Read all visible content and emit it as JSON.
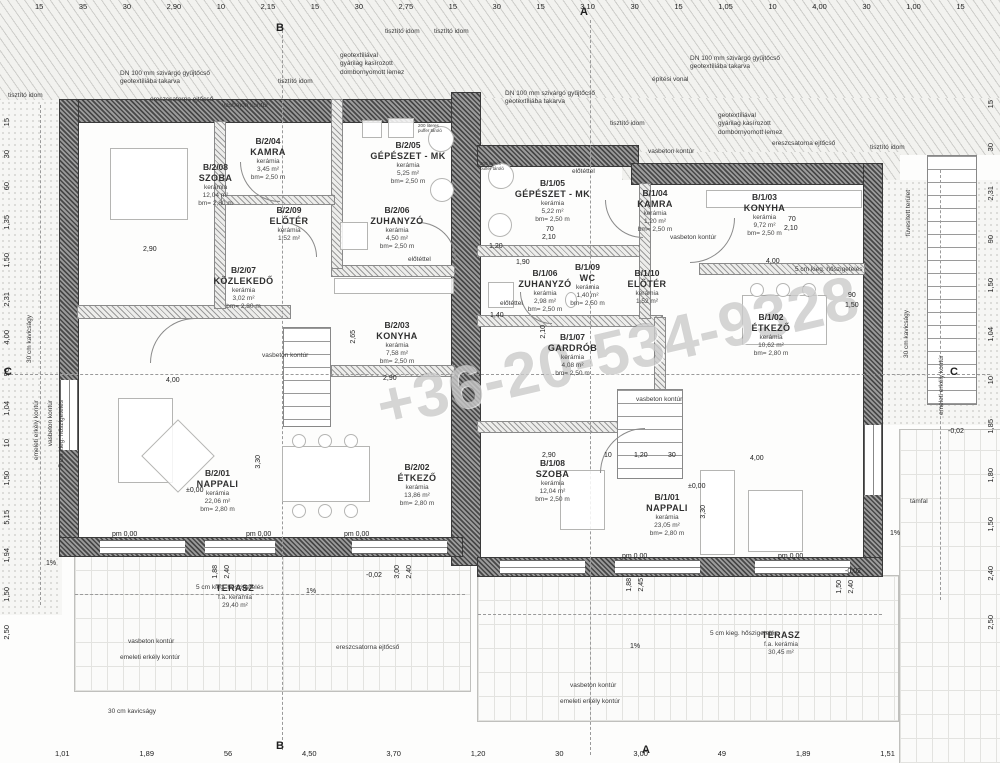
{
  "watermark": {
    "text": "+36-20-534-9328"
  },
  "colors": {
    "paper": "#fdfdfc",
    "wall_dark": "#474747",
    "hatch_line": "#cdcdca",
    "text": "#2f2f2f",
    "watermark": "rgba(115,115,115,0.30)"
  },
  "rooms": [
    {
      "id": "B/2/08",
      "name": "SZOBA",
      "mat": "kerámia",
      "area": "12,04 m²",
      "hgt": "bm= 2,80 m",
      "x": 168,
      "y": 162,
      "w": 95
    },
    {
      "id": "B/2/04",
      "name": "KAMRA",
      "mat": "kerámia",
      "area": "3,45 m²",
      "hgt": "bm= 2,50 m",
      "x": 228,
      "y": 136,
      "w": 80
    },
    {
      "id": "B/2/05",
      "name": "GÉPÉSZET - MK",
      "mat": "kerámia",
      "area": "5,25 m²",
      "hgt": "bm= 2,50 m",
      "x": 358,
      "y": 140,
      "w": 100
    },
    {
      "id": "B/2/09",
      "name": "ELŐTÉR",
      "mat": "kerámia",
      "area": "1,52 m²",
      "hgt": "",
      "x": 250,
      "y": 205,
      "w": 78
    },
    {
      "id": "B/2/06",
      "name": "ZUHANYZÓ",
      "mat": "kerámia",
      "area": "4,50 m²",
      "hgt": "bm= 2,50 m",
      "x": 352,
      "y": 205,
      "w": 90
    },
    {
      "id": "B/2/07",
      "name": "KÖZLEKEDŐ",
      "mat": "kerámia",
      "area": "3,02 m²",
      "hgt": "bm= 2,80 m",
      "x": 196,
      "y": 265,
      "w": 95
    },
    {
      "id": "B/2/03",
      "name": "KONYHA",
      "mat": "kerámia",
      "area": "7,58 m²",
      "hgt": "bm= 2,50 m",
      "x": 352,
      "y": 320,
      "w": 90
    },
    {
      "id": "B/2/01",
      "name": "NAPPALI",
      "mat": "kerámia",
      "area": "22,06 m²",
      "hgt": "bm= 2,80 m",
      "x": 170,
      "y": 468,
      "w": 95
    },
    {
      "id": "B/2/02",
      "name": "ÉTKEZŐ",
      "mat": "kerámia",
      "area": "13,86 m²",
      "hgt": "bm= 2,80 m",
      "x": 372,
      "y": 462,
      "w": 90
    },
    {
      "id": "",
      "name": "TERASZ",
      "mat": "f.a. kerámia",
      "area": "29,40 m²",
      "hgt": "",
      "x": 190,
      "y": 583,
      "w": 90
    },
    {
      "id": "B/1/05",
      "name": "GÉPÉSZET - MK",
      "mat": "kerámia",
      "area": "5,22 m²",
      "hgt": "bm= 2,50 m",
      "x": 500,
      "y": 178,
      "w": 105
    },
    {
      "id": "B/1/04",
      "name": "KAMRA",
      "mat": "kerámia",
      "area": "1,20 m²",
      "hgt": "bm= 2,50 m",
      "x": 615,
      "y": 188,
      "w": 80
    },
    {
      "id": "B/1/03",
      "name": "KONYHA",
      "mat": "kerámia",
      "area": "9,72 m²",
      "hgt": "bm= 2,50 m",
      "x": 722,
      "y": 192,
      "w": 85
    },
    {
      "id": "B/1/06",
      "name": "ZUHANYZÓ",
      "mat": "kerámia",
      "area": "2,98 m²",
      "hgt": "bm= 2,50 m",
      "x": 500,
      "y": 268,
      "w": 90
    },
    {
      "id": "B/1/09",
      "name": "WC",
      "mat": "kerámia",
      "area": "1,40 m²",
      "hgt": "bm= 2,50 m",
      "x": 560,
      "y": 262,
      "w": 55
    },
    {
      "id": "B/1/10",
      "name": "ELŐTÉR",
      "mat": "kerámia",
      "area": "1,52 m²",
      "hgt": "",
      "x": 612,
      "y": 268,
      "w": 70
    },
    {
      "id": "B/1/07",
      "name": "GARDRÓB",
      "mat": "kerámia",
      "area": "4,08 m²",
      "hgt": "bm= 2,50 m",
      "x": 530,
      "y": 332,
      "w": 85
    },
    {
      "id": "B/1/02",
      "name": "ÉTKEZŐ",
      "mat": "kerámia",
      "area": "10,62 m²",
      "hgt": "bm= 2,80 m",
      "x": 726,
      "y": 312,
      "w": 90
    },
    {
      "id": "B/1/08",
      "name": "SZOBA",
      "mat": "kerámia",
      "area": "12,04 m²",
      "hgt": "bm= 2,50 m",
      "x": 510,
      "y": 458,
      "w": 85
    },
    {
      "id": "B/1/01",
      "name": "NAPPALI",
      "mat": "kerámia",
      "area": "23,05 m²",
      "hgt": "bm= 2,80 m",
      "x": 622,
      "y": 492,
      "w": 90
    },
    {
      "id": "",
      "name": "TERASZ",
      "mat": "f.a. kerámia",
      "area": "30,45 m²",
      "hgt": "",
      "x": 736,
      "y": 630,
      "w": 90
    }
  ],
  "annotations": [
    {
      "t": "geotextíliával\ngyárilag kasírozott\ndombornyomott lemez",
      "x": 340,
      "y": 52
    },
    {
      "t": "DN 100 mm szivárgó gyűjtőcső\ngeotextíliába takarva",
      "x": 120,
      "y": 70
    },
    {
      "t": "ereszcsatorna ejtőcső",
      "x": 150,
      "y": 96
    },
    {
      "t": "tisztító idom",
      "x": 8,
      "y": 92
    },
    {
      "t": "vasbeton kontúr",
      "x": 222,
      "y": 102
    },
    {
      "t": "tisztító idom",
      "x": 278,
      "y": 78
    },
    {
      "t": "tisztító idom",
      "x": 385,
      "y": 28
    },
    {
      "t": "tisztító idom",
      "x": 434,
      "y": 28
    },
    {
      "t": "építési vonal",
      "x": 652,
      "y": 76
    },
    {
      "t": "DN 100 mm szivárgó gyűjtőcső\ngeotextíliába takarva",
      "x": 505,
      "y": 90
    },
    {
      "t": "DN 100 mm szivárgó gyűjtőcső\ngeotextíliába takarva",
      "x": 690,
      "y": 55
    },
    {
      "t": "geotextíliával\ngyárilag kasírozott\ndombornyomott lemez",
      "x": 718,
      "y": 112
    },
    {
      "t": "ereszcsatorna ejtőcső",
      "x": 772,
      "y": 140
    },
    {
      "t": "tisztító idom",
      "x": 610,
      "y": 120
    },
    {
      "t": "tisztító idom",
      "x": 870,
      "y": 144
    },
    {
      "t": "vasbeton kontúr",
      "x": 648,
      "y": 148
    },
    {
      "t": "füvesített terület",
      "x": 905,
      "y": 190,
      "cls": "vert"
    },
    {
      "t": "5 cm kieg. hőszigetelés",
      "x": 795,
      "y": 266
    },
    {
      "t": "5 cm kieg. hőszigetelés",
      "x": 196,
      "y": 584
    },
    {
      "t": "5 cm kieg. hőszigetelés",
      "x": 710,
      "y": 630
    },
    {
      "t": "5 cm kieg. hőszigetelés",
      "x": 58,
      "y": 400,
      "cls": "vert"
    },
    {
      "t": "vasbeton kontúr",
      "x": 47,
      "y": 400,
      "cls": "vert"
    },
    {
      "t": "emeleti erkély kontúr",
      "x": 33,
      "y": 400,
      "cls": "vert"
    },
    {
      "t": "vasbeton kontúr",
      "x": 128,
      "y": 638
    },
    {
      "t": "emeleti erkély kontúr",
      "x": 120,
      "y": 654
    },
    {
      "t": "vasbeton kontúr",
      "x": 570,
      "y": 682
    },
    {
      "t": "emeleti erkély kontúr",
      "x": 560,
      "y": 698
    },
    {
      "t": "vasbeton kontúr",
      "x": 636,
      "y": 396
    },
    {
      "t": "vasbeton kontúr",
      "x": 262,
      "y": 352
    },
    {
      "t": "vasbeton kontúr",
      "x": 670,
      "y": 234
    },
    {
      "t": "támfal",
      "x": 910,
      "y": 498
    },
    {
      "t": "30 cm kavicságy",
      "x": 108,
      "y": 708
    },
    {
      "t": "30 cm kavicságy",
      "x": 26,
      "y": 315,
      "cls": "vert"
    },
    {
      "t": "30 cm kavicságy",
      "x": 903,
      "y": 310,
      "cls": "vert"
    },
    {
      "t": "emeleti erkély kontúr",
      "x": 938,
      "y": 355,
      "cls": "vert"
    },
    {
      "t": "ereszcsatorna ejtőcső",
      "x": 336,
      "y": 644
    },
    {
      "t": "előtéttel",
      "x": 408,
      "y": 256
    },
    {
      "t": "előtéttel",
      "x": 500,
      "y": 300
    },
    {
      "t": "előtéttel",
      "x": 572,
      "y": 168
    },
    {
      "t": "200 literes\npuffer tároló",
      "x": 418,
      "y": 124,
      "cls": "tiny"
    },
    {
      "t": "200 literes\npuffer tároló",
      "x": 480,
      "y": 162,
      "cls": "tiny"
    }
  ],
  "inline_dims": [
    {
      "t": "2,90",
      "x": 143,
      "y": 246
    },
    {
      "t": "4,00",
      "x": 166,
      "y": 377
    },
    {
      "t": "3,30",
      "x": 255,
      "y": 455,
      "cls": "vert"
    },
    {
      "t": "2,65",
      "x": 350,
      "y": 330,
      "cls": "vert"
    },
    {
      "t": "2,90",
      "x": 383,
      "y": 375
    },
    {
      "t": "1,20",
      "x": 489,
      "y": 243
    },
    {
      "t": "1,90",
      "x": 516,
      "y": 259
    },
    {
      "t": "1,40",
      "x": 490,
      "y": 312
    },
    {
      "t": "2,10",
      "x": 540,
      "y": 325,
      "cls": "vert"
    },
    {
      "t": "10",
      "x": 604,
      "y": 452
    },
    {
      "t": "1,20",
      "x": 634,
      "y": 452
    },
    {
      "t": "30",
      "x": 668,
      "y": 452
    },
    {
      "t": "4,00",
      "x": 750,
      "y": 455
    },
    {
      "t": "4,00",
      "x": 766,
      "y": 258
    },
    {
      "t": "3,30",
      "x": 700,
      "y": 505,
      "cls": "vert"
    },
    {
      "t": "2,90",
      "x": 542,
      "y": 452
    },
    {
      "t": "70",
      "x": 788,
      "y": 216
    },
    {
      "t": "2,10",
      "x": 784,
      "y": 225
    },
    {
      "t": "70",
      "x": 546,
      "y": 226
    },
    {
      "t": "2,10",
      "x": 542,
      "y": 234
    },
    {
      "t": "90",
      "x": 848,
      "y": 292
    },
    {
      "t": "1,50",
      "x": 845,
      "y": 302
    },
    {
      "t": "1,88",
      "x": 212,
      "y": 565,
      "cls": "vert"
    },
    {
      "t": "2,40",
      "x": 224,
      "y": 565,
      "cls": "vert"
    },
    {
      "t": "3,00",
      "x": 394,
      "y": 565,
      "cls": "vert"
    },
    {
      "t": "2,40",
      "x": 406,
      "y": 565,
      "cls": "vert"
    },
    {
      "t": "1,88",
      "x": 626,
      "y": 578,
      "cls": "vert"
    },
    {
      "t": "2,45",
      "x": 638,
      "y": 578,
      "cls": "vert"
    },
    {
      "t": "1,50",
      "x": 836,
      "y": 580,
      "cls": "vert"
    },
    {
      "t": "2,40",
      "x": 848,
      "y": 580,
      "cls": "vert"
    },
    {
      "t": "-0,02",
      "x": 366,
      "y": 572
    },
    {
      "t": "-0,02",
      "x": 845,
      "y": 568
    },
    {
      "t": "-0,02",
      "x": 948,
      "y": 428
    },
    {
      "t": "±0,00",
      "x": 186,
      "y": 487
    },
    {
      "t": "±0,00",
      "x": 688,
      "y": 483
    },
    {
      "t": "pm 0,00",
      "x": 112,
      "y": 531
    },
    {
      "t": "pm 0,00",
      "x": 246,
      "y": 531
    },
    {
      "t": "pm 0,00",
      "x": 344,
      "y": 531
    },
    {
      "t": "pm 0,00",
      "x": 622,
      "y": 553
    },
    {
      "t": "pm 0,00",
      "x": 778,
      "y": 553
    },
    {
      "t": "1%",
      "x": 306,
      "y": 588
    },
    {
      "t": "1%",
      "x": 630,
      "y": 643
    },
    {
      "t": "1%",
      "x": 890,
      "y": 530
    },
    {
      "t": "1%",
      "x": 46,
      "y": 560
    }
  ],
  "dim_rows": {
    "top": [
      "15",
      "35",
      "30",
      "2,90",
      "10",
      "2,15",
      "15",
      "30",
      "2,75",
      "15",
      "30",
      "15",
      "3,10",
      "30",
      "15",
      "1,05",
      "10",
      "4,00",
      "30",
      "1,00",
      "15"
    ],
    "bottom": [
      "1,01",
      "1,89",
      "56",
      "4,50",
      "3,70",
      "1,20",
      "30",
      "3,00",
      "49",
      "1,89",
      "1,51"
    ],
    "left": [
      "15",
      "30",
      "60",
      "1,35",
      "1,50",
      "2,31",
      "4,00",
      "90",
      "1,04",
      "10",
      "1,50",
      "5,15",
      "1,94",
      "1,50",
      "2,50"
    ],
    "right": [
      "15",
      "30",
      "2,31",
      "90",
      "1,50",
      "1,04",
      "10",
      "1,85",
      "1,80",
      "1,50",
      "2,40",
      "2,50"
    ]
  },
  "section_markers": [
    {
      "t": "A",
      "x": 580,
      "y": 6
    },
    {
      "t": "B",
      "x": 276,
      "y": 22
    },
    {
      "t": "A",
      "x": 642,
      "y": 744
    },
    {
      "t": "B",
      "x": 276,
      "y": 740
    },
    {
      "t": "C",
      "x": 4,
      "y": 366
    },
    {
      "t": "C",
      "x": 950,
      "y": 366
    }
  ],
  "shapes": [
    {
      "cls": "hatch",
      "x": 0,
      "y": 0,
      "w": 1000,
      "h": 100
    },
    {
      "cls": "hatch",
      "x": 455,
      "y": 98,
      "w": 545,
      "h": 57
    },
    {
      "cls": "hatch",
      "x": 622,
      "y": 152,
      "w": 278,
      "h": 28
    },
    {
      "cls": "gravel",
      "x": 0,
      "y": 100,
      "w": 62,
      "h": 515
    },
    {
      "cls": "gravel",
      "x": 880,
      "y": 180,
      "w": 120,
      "h": 245
    },
    {
      "cls": "terrace",
      "x": 900,
      "y": 430,
      "w": 100,
      "h": 333
    },
    {
      "cls": "terrace",
      "x": 75,
      "y": 556,
      "w": 395,
      "h": 135
    },
    {
      "cls": "terrace",
      "x": 478,
      "y": 576,
      "w": 420,
      "h": 145
    },
    {
      "cls": "wall",
      "x": 60,
      "y": 100,
      "w": 402,
      "h": 22
    },
    {
      "cls": "wall",
      "x": 452,
      "y": 93,
      "w": 28,
      "h": 472
    },
    {
      "cls": "wall",
      "x": 478,
      "y": 146,
      "w": 160,
      "h": 20
    },
    {
      "cls": "wall",
      "x": 632,
      "y": 164,
      "w": 250,
      "h": 20
    },
    {
      "cls": "wall",
      "x": 60,
      "y": 100,
      "w": 18,
      "h": 456
    },
    {
      "cls": "wall",
      "x": 864,
      "y": 164,
      "w": 18,
      "h": 402
    },
    {
      "cls": "wall",
      "x": 60,
      "y": 538,
      "w": 402,
      "h": 18
    },
    {
      "cls": "wall",
      "x": 478,
      "y": 558,
      "w": 404,
      "h": 18
    },
    {
      "cls": "iwall",
      "x": 78,
      "y": 306,
      "w": 212,
      "h": 12
    },
    {
      "cls": "iwall",
      "x": 332,
      "y": 266,
      "w": 122,
      "h": 10
    },
    {
      "cls": "iwall",
      "x": 332,
      "y": 366,
      "w": 122,
      "h": 10
    },
    {
      "cls": "iwall",
      "x": 215,
      "y": 122,
      "w": 10,
      "h": 186
    },
    {
      "cls": "iwall",
      "x": 332,
      "y": 100,
      "w": 10,
      "h": 168
    },
    {
      "cls": "iwall",
      "x": 222,
      "y": 196,
      "w": 112,
      "h": 8
    },
    {
      "cls": "iwall",
      "x": 478,
      "y": 246,
      "w": 162,
      "h": 10
    },
    {
      "cls": "iwall",
      "x": 478,
      "y": 316,
      "w": 184,
      "h": 10
    },
    {
      "cls": "iwall",
      "x": 640,
      "y": 184,
      "w": 10,
      "h": 134
    },
    {
      "cls": "iwall",
      "x": 700,
      "y": 264,
      "w": 164,
      "h": 10
    },
    {
      "cls": "iwall",
      "x": 478,
      "y": 422,
      "w": 186,
      "h": 10
    },
    {
      "cls": "iwall",
      "x": 655,
      "y": 318,
      "w": 10,
      "h": 106
    },
    {
      "cls": "window",
      "x": 100,
      "y": 540,
      "w": 85,
      "h": 14
    },
    {
      "cls": "window",
      "x": 205,
      "y": 540,
      "w": 70,
      "h": 14
    },
    {
      "cls": "window",
      "x": 352,
      "y": 540,
      "w": 95,
      "h": 14
    },
    {
      "cls": "window",
      "x": 500,
      "y": 560,
      "w": 85,
      "h": 14
    },
    {
      "cls": "window",
      "x": 615,
      "y": 560,
      "w": 85,
      "h": 14
    },
    {
      "cls": "window",
      "x": 755,
      "y": 560,
      "w": 95,
      "h": 14
    },
    {
      "cls": "windowv",
      "x": 60,
      "y": 380,
      "w": 18,
      "h": 70
    },
    {
      "cls": "windowv",
      "x": 864,
      "y": 425,
      "w": 18,
      "h": 70
    },
    {
      "cls": "stairs",
      "x": 284,
      "y": 328,
      "w": 46,
      "h": 98
    },
    {
      "cls": "stairs",
      "x": 618,
      "y": 390,
      "w": 64,
      "h": 88
    },
    {
      "cls": "stairs",
      "x": 928,
      "y": 156,
      "w": 48,
      "h": 248
    },
    {
      "cls": "dashv",
      "x": 282,
      "y": 25,
      "w": 0,
      "h": 725
    },
    {
      "cls": "dashv",
      "x": 590,
      "y": 20,
      "w": 0,
      "h": 735
    },
    {
      "cls": "dashh",
      "x": 10,
      "y": 374,
      "w": 980,
      "h": 0
    },
    {
      "cls": "dashh",
      "x": 75,
      "y": 594,
      "w": 390,
      "h": 0
    },
    {
      "cls": "dashh",
      "x": 478,
      "y": 614,
      "w": 404,
      "h": 0
    },
    {
      "cls": "dashv",
      "x": 40,
      "y": 105,
      "w": 0,
      "h": 500
    },
    {
      "cls": "dashv",
      "x": 940,
      "y": 170,
      "w": 0,
      "h": 430
    },
    {
      "cls": "fbox",
      "x": 110,
      "y": 148,
      "w": 78,
      "h": 72
    },
    {
      "cls": "fbox",
      "x": 118,
      "y": 398,
      "w": 55,
      "h": 85
    },
    {
      "cls": "fbox",
      "x": 152,
      "y": 430,
      "w": 52,
      "h": 52,
      "rot": 45
    },
    {
      "cls": "fbox",
      "x": 282,
      "y": 446,
      "w": 88,
      "h": 56
    },
    {
      "cls": "fcirc",
      "x": 292,
      "y": 434,
      "w": 14,
      "h": 14
    },
    {
      "cls": "fcirc",
      "x": 318,
      "y": 434,
      "w": 14,
      "h": 14
    },
    {
      "cls": "fcirc",
      "x": 344,
      "y": 434,
      "w": 14,
      "h": 14
    },
    {
      "cls": "fcirc",
      "x": 292,
      "y": 504,
      "w": 14,
      "h": 14
    },
    {
      "cls": "fcirc",
      "x": 318,
      "y": 504,
      "w": 14,
      "h": 14
    },
    {
      "cls": "fcirc",
      "x": 344,
      "y": 504,
      "w": 14,
      "h": 14
    },
    {
      "cls": "fbox",
      "x": 334,
      "y": 278,
      "w": 120,
      "h": 16
    },
    {
      "cls": "fbox",
      "x": 362,
      "y": 120,
      "w": 20,
      "h": 18
    },
    {
      "cls": "fbox",
      "x": 388,
      "y": 118,
      "w": 26,
      "h": 20
    },
    {
      "cls": "fbox",
      "x": 706,
      "y": 190,
      "w": 156,
      "h": 18
    },
    {
      "cls": "fbox",
      "x": 742,
      "y": 295,
      "w": 85,
      "h": 50
    },
    {
      "cls": "fcirc",
      "x": 750,
      "y": 283,
      "w": 14,
      "h": 14
    },
    {
      "cls": "fcirc",
      "x": 776,
      "y": 283,
      "w": 14,
      "h": 14
    },
    {
      "cls": "fcirc",
      "x": 802,
      "y": 283,
      "w": 14,
      "h": 14
    },
    {
      "cls": "fbox",
      "x": 700,
      "y": 470,
      "w": 35,
      "h": 85
    },
    {
      "cls": "fbox",
      "x": 748,
      "y": 490,
      "w": 55,
      "h": 62
    },
    {
      "cls": "fbox",
      "x": 560,
      "y": 470,
      "w": 45,
      "h": 60
    },
    {
      "cls": "fbox",
      "x": 340,
      "y": 222,
      "w": 28,
      "h": 28
    },
    {
      "cls": "fbox",
      "x": 488,
      "y": 282,
      "w": 26,
      "h": 26
    },
    {
      "cls": "fcirc",
      "x": 565,
      "y": 292,
      "w": 12,
      "h": 16
    },
    {
      "cls": "fcirc",
      "x": 428,
      "y": 126,
      "w": 26,
      "h": 26
    },
    {
      "cls": "fcirc",
      "x": 430,
      "y": 178,
      "w": 24,
      "h": 24
    },
    {
      "cls": "fcirc",
      "x": 488,
      "y": 163,
      "w": 26,
      "h": 26
    },
    {
      "cls": "fcirc",
      "x": 488,
      "y": 213,
      "w": 24,
      "h": 24
    },
    {
      "cls": "arc",
      "x": 240,
      "y": 162,
      "w": 40,
      "h": 40
    },
    {
      "cls": "arc",
      "x": 150,
      "y": 318,
      "w": 45,
      "h": 45,
      "rot": 90
    },
    {
      "cls": "arc",
      "x": 418,
      "y": 222,
      "w": 38,
      "h": 38,
      "rot": 180
    },
    {
      "cls": "arc",
      "x": 690,
      "y": 218,
      "w": 45,
      "h": 45,
      "rot": 270
    },
    {
      "cls": "arc",
      "x": 520,
      "y": 292,
      "w": 32,
      "h": 32
    },
    {
      "cls": "arc",
      "x": 600,
      "y": 428,
      "w": 45,
      "h": 45,
      "rot": 90
    },
    {
      "cls": "arc",
      "x": 282,
      "y": 222,
      "w": 35,
      "h": 35,
      "rot": 180
    },
    {
      "cls": "arc",
      "x": 605,
      "y": 200,
      "w": 38,
      "h": 38
    }
  ]
}
